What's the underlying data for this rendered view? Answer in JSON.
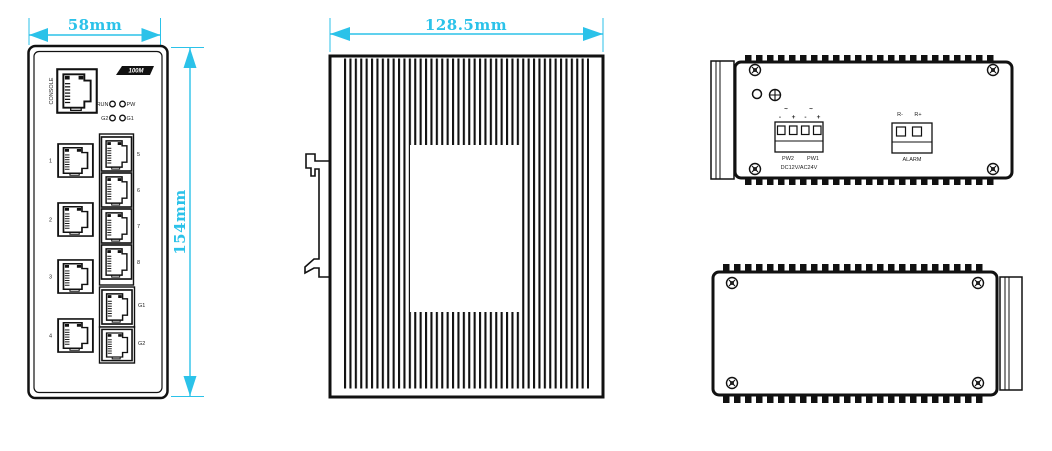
{
  "title": "industrial-ethernet-switch-dimension-drawing",
  "colors": {
    "dimension_cyan": "#2BC2E9",
    "line_black": "#111111"
  },
  "front_view": {
    "width_dim": "58mm",
    "height_dim": "154mm",
    "console_label": "CONSOLE",
    "badge_label": "100M",
    "led_labels": {
      "run": "RUN",
      "pw": "PW",
      "g2": "G2",
      "g1": "G1"
    },
    "port_labels": [
      "1",
      "2",
      "3",
      "4",
      "5",
      "6",
      "7",
      "8"
    ],
    "giga_port_labels": [
      "G1",
      "G2"
    ]
  },
  "side_view": {
    "width_dim": "128.5mm"
  },
  "top_view": {
    "ac_symbols": [
      "~",
      "~"
    ],
    "polarity_marks": [
      "-",
      "+",
      "-",
      "+"
    ],
    "power_labels": [
      "PW2",
      "PW1"
    ],
    "power_rating": "DC12V/AC24V",
    "relay_labels": [
      "R-",
      "R+"
    ],
    "alarm_label": "ALARM"
  }
}
